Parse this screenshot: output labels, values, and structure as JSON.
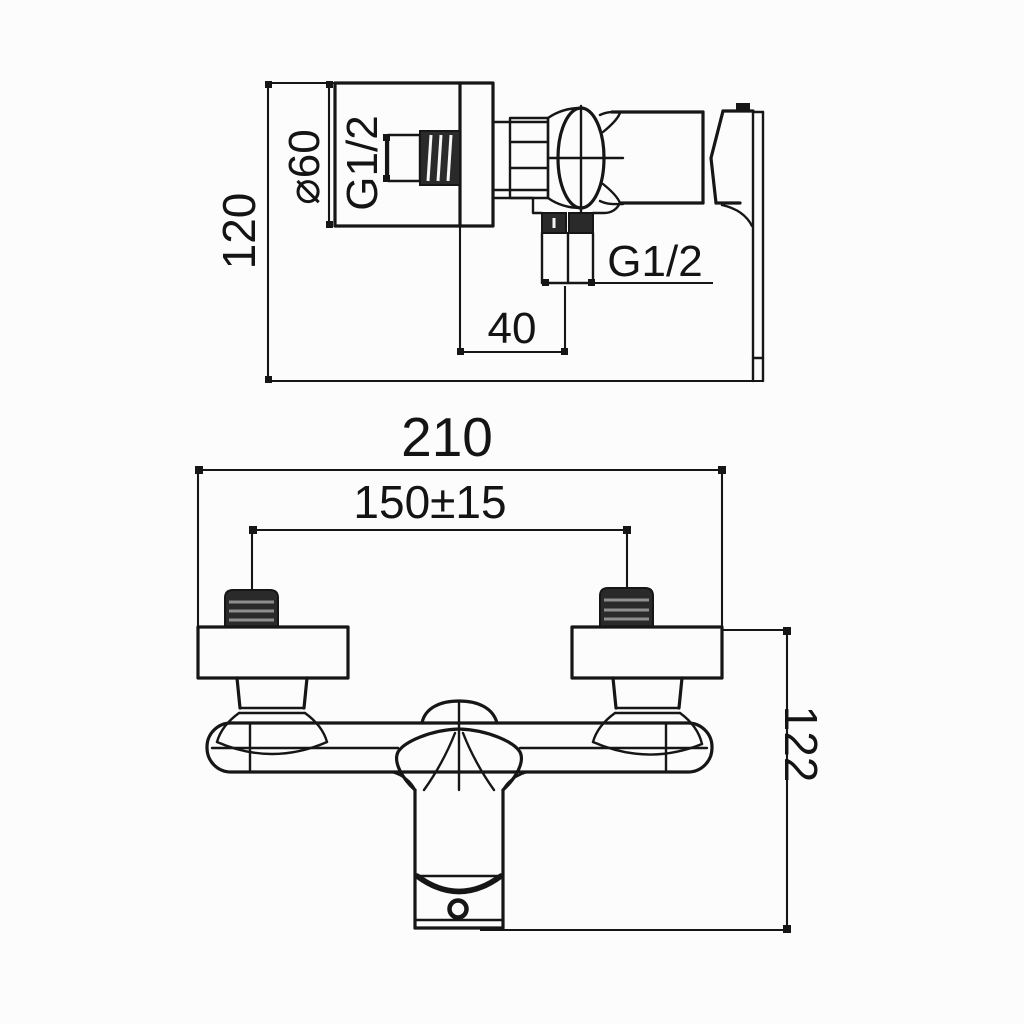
{
  "page": {
    "background": "#fcfcfc"
  },
  "colors": {
    "line": "#161616",
    "thread_dark": "#2a2a2a",
    "thread_stripe": "#8f8f8f"
  },
  "views": {
    "side_view": {
      "labels": {
        "height": "120",
        "flange_diameter": "⌀60",
        "wall_thread": "G1/2",
        "outlet_thread": "G1/2",
        "outlet_offset": "40"
      }
    },
    "front_view": {
      "labels": {
        "overall_width": "210",
        "inlet_spacing": "150±15",
        "overall_height": "122"
      }
    }
  }
}
